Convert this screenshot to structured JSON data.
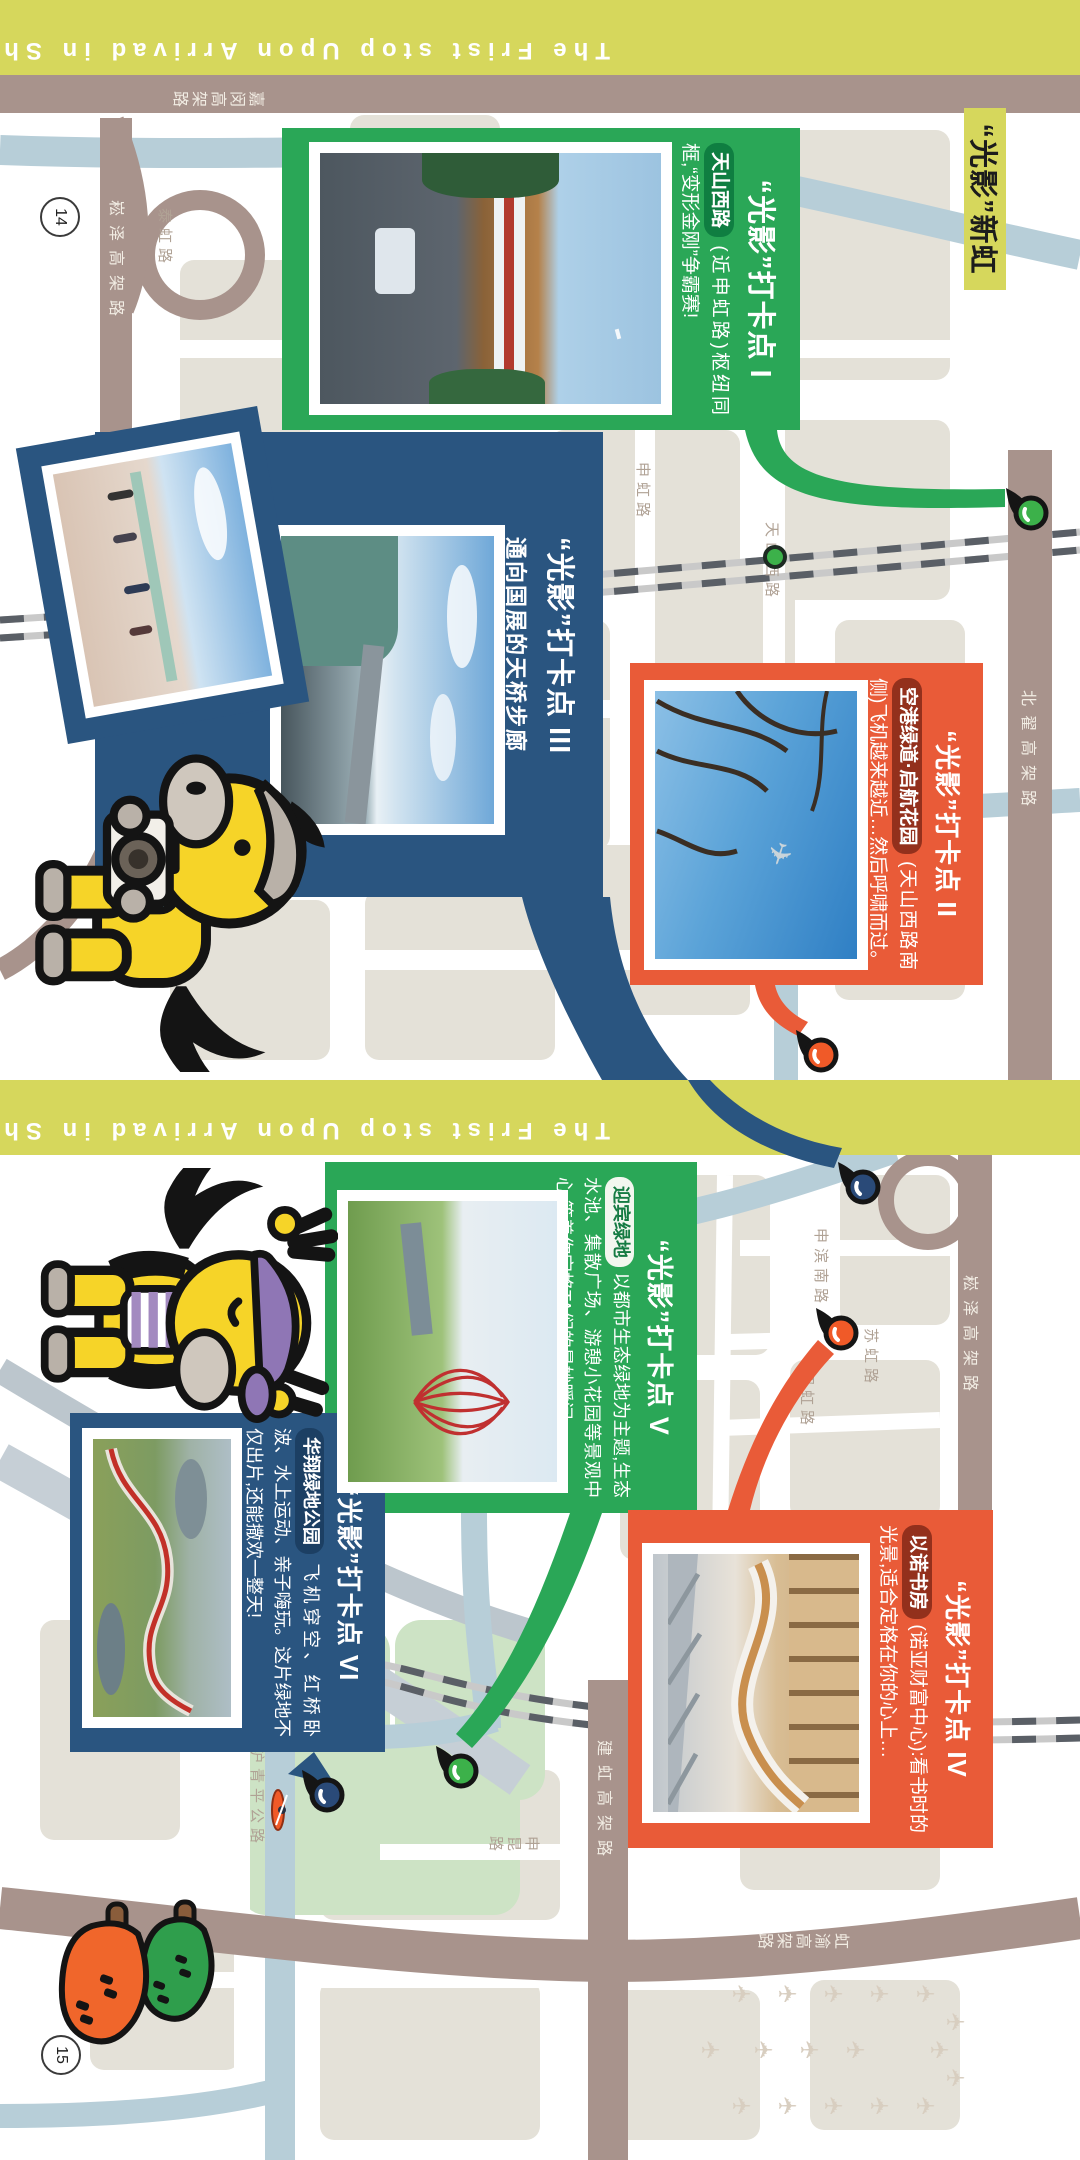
{
  "spread": {
    "section_title": "“光影”新虹",
    "band_text": "The Frist stop Upon Arrivad in Shanghai"
  },
  "pages": [
    {
      "number": "14",
      "band_text": "The Frist stop Upon Arrivad in Shanghai",
      "labels": [
        {
          "text": "嘉闵高架路"
        },
        {
          "text": "北翟高架路"
        },
        {
          "text": "崧泽高架路"
        },
        {
          "text": "泰虹路"
        },
        {
          "text": "天山西路"
        },
        {
          "text": "申虹路"
        },
        {
          "text": "宁虹路"
        }
      ],
      "cards": [
        {
          "title": "“光影”打卡点 I",
          "pill": "天山西路",
          "body": "(近申虹路)枢纽同框,“变形金刚”争霸赛!"
        },
        {
          "title": "“光影”打卡点 II",
          "pill": "空港绿道·启航花园",
          "body": "(天山西路南侧)飞机越来越近…然后呼啸而过。"
        },
        {
          "title": "“光影”打卡点 III",
          "pill": "",
          "body": "通向国展的天桥步廊"
        }
      ]
    },
    {
      "number": "15",
      "band_text": "The Frist stop Upon Arrivad in Shanghai",
      "labels": [
        {
          "text": "崧泽高架路"
        },
        {
          "text": "申滨南路"
        },
        {
          "text": "苏虹路"
        },
        {
          "text": "绍虹路"
        },
        {
          "text": "建虹高架路"
        },
        {
          "text": "虹渝高架路"
        },
        {
          "text": "沪青平公路"
        },
        {
          "text": "申昆路"
        }
      ],
      "cards": [
        {
          "title": "“光影”打卡点 V",
          "pill": "迎宾绿地",
          "body": "以都市生态绿地为主题,生态水池、集散广场、游憩小花园等景观中心,等着你定格TA们的曼妙瞬间。"
        },
        {
          "title": "“光影”打卡点 VI",
          "pill": "华翔绿地公园",
          "body": "飞机穿空、红桥卧波、水上运动、亲子嗨玩。这片绿地不仅出片,还能撒欢一整天!"
        },
        {
          "title": "“光影”打卡点 IV",
          "pill": "以诺书房",
          "body": "(诺亚财富中心):看书时的光景,适合定格在你的心上…"
        }
      ]
    }
  ],
  "icons": {
    "pin": "map-pin-teardrop",
    "plane": "✈",
    "kayak": "kayak-paddler",
    "mascot_camera": "pony-with-camera",
    "mascot_peace": "pony-peace-sign",
    "veggies": "vegetable-blobs"
  },
  "colors": {
    "band_yellow": "#d6d75c",
    "card_green": "#2aa757",
    "card_navy": "#2a5580",
    "card_orange": "#e95b38",
    "road_brown": "#a8938c",
    "river_blue": "#b7ced8",
    "park_green": "#cde3c5"
  }
}
